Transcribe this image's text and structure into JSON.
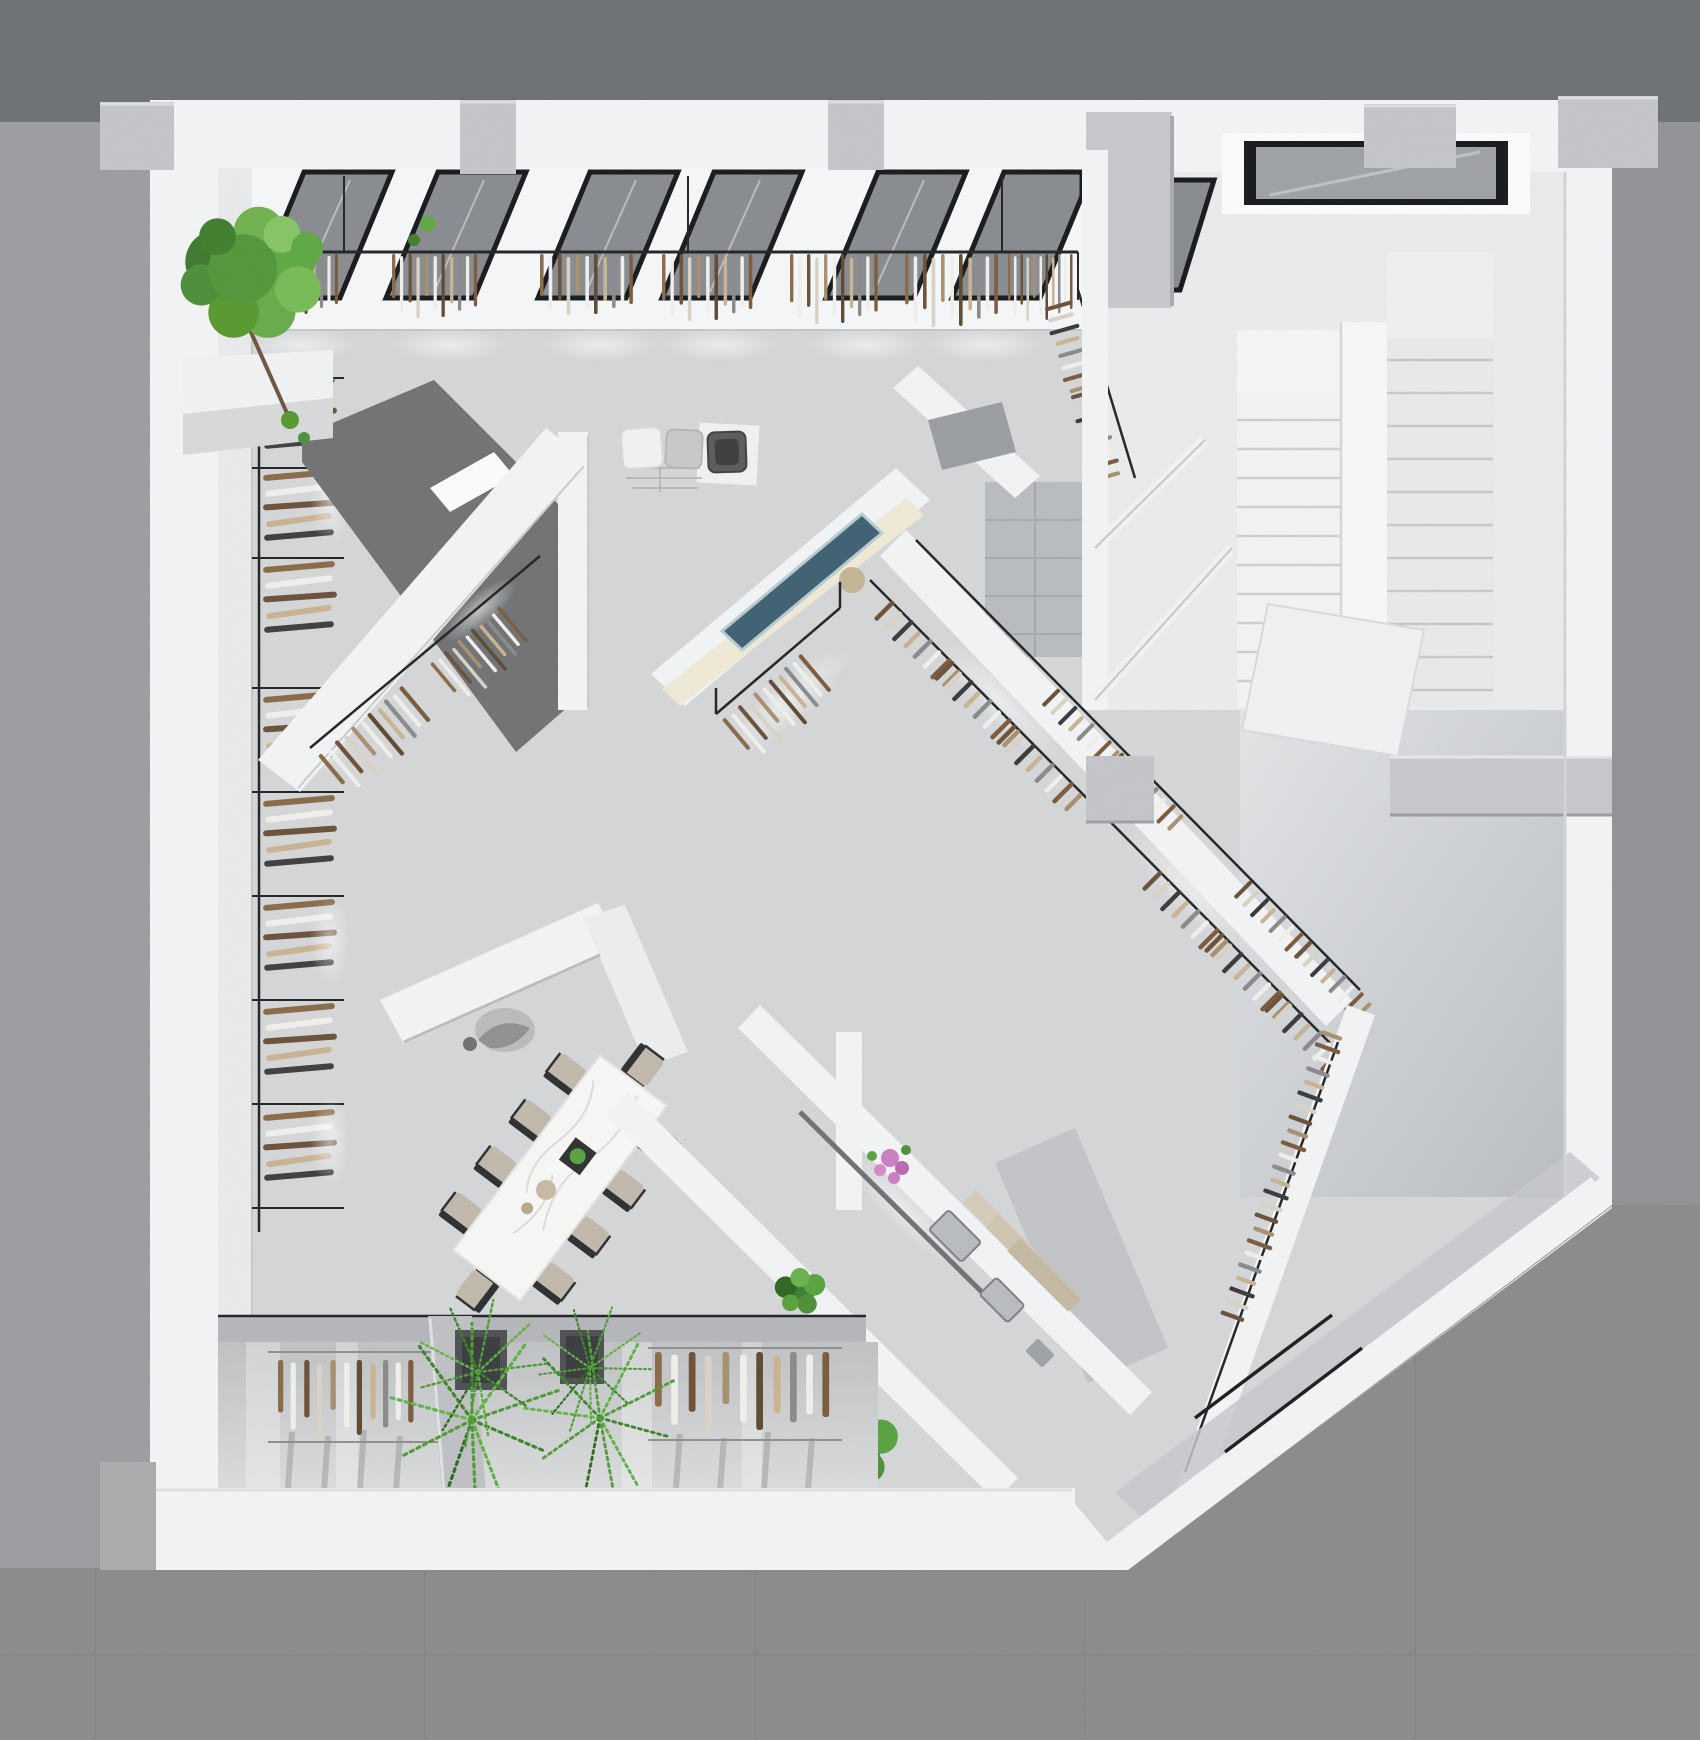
{
  "scene": {
    "description": "Top-down 3D architectural render of a minimalist fashion retail store floor plan",
    "view": "top-down plan render",
    "style": "white walls, speckled terrazzo floors, black display rails, green plants"
  },
  "palette": {
    "exterior_top": "#6d7074",
    "exterior_side": "#9c9da0",
    "exterior_right": "#909295",
    "exterior_concrete": "#8a8b8b",
    "wall_white": "#f3f4f6",
    "wall_face_shadow": "#e8eaec",
    "pilaster_gray": "#c3c5c8",
    "floor_main": "#d5d6d8",
    "floor_stair_hall": "#eaebed",
    "floor_understair": "#dfe1e4",
    "floor_gloss_top": "#bfc1c3",
    "floor_gloss_bottom": "#dadcde",
    "floor_tile_gray": "#b9bcbe",
    "carpet_dark": "#707274",
    "window_frame": "#17191b",
    "window_glass": "#888b8f",
    "skylight_glass": "#9fa2a5",
    "rail_black": "#222426",
    "screen_teal": "#3e6173",
    "screen_frame": "#b8ccd2",
    "lightbox_cream": "#efe9d6",
    "marble_white": "#f7f7f5",
    "chair_beige": "#c0b9ab",
    "chair_frame": "#2e2f31",
    "tree_green": "#4c8f3a",
    "fern_green": "#4f9c35",
    "bush_green": "#3f7d2f",
    "flower_pink": "#c97fc0",
    "steps_beige": "#d5ccb8",
    "counter_metal": "#b9bcbf",
    "planter_dark": "#4e5053",
    "stool_tan": "#c2b493",
    "pouf_white": "#f2f2f2",
    "pouf_gray": "#c7c8ca",
    "pouf_dark": "#595b5d",
    "garment_brown": "#6b513a",
    "garment_tan": "#c9b392",
    "garment_white": "#f0efec",
    "garment_black": "#3a3a3c",
    "garment_gray": "#8a8a8c"
  },
  "elements": {
    "facade_windows": {
      "count": 7,
      "type": "full-height glazing, dark frames"
    },
    "skylight": {
      "count": 1,
      "location": "stair hall"
    },
    "staircase": {
      "flights": 2,
      "treads_per_flight": 10,
      "divider_wall": true
    },
    "hanging_rail_sections_top_wall": 7,
    "left_wall_shelf_stacks": 8,
    "diagonal_shoe_wall_clusters": 12,
    "display_wall_screen": {
      "count": 1,
      "color": "teal"
    },
    "pouf_squares": {
      "count": 3,
      "colors": [
        "white",
        "gray",
        "dark gray"
      ]
    },
    "dining_table": {
      "chairs": 10,
      "top": "white marble",
      "decor": [
        "plant box",
        "round trays"
      ]
    },
    "v_shaped_stand": {
      "count": 1,
      "mannequin": true
    },
    "cash_counter": {
      "registers": 2,
      "flowers": "pink bouquet"
    },
    "entry_steps": {
      "count": 3,
      "finish": "beige"
    },
    "glass_entry_door_lines": 2,
    "plants": {
      "tree": 1,
      "ferns": 2,
      "bushes": 2
    },
    "window_display_planters": 2,
    "window_display_bays": 2
  }
}
